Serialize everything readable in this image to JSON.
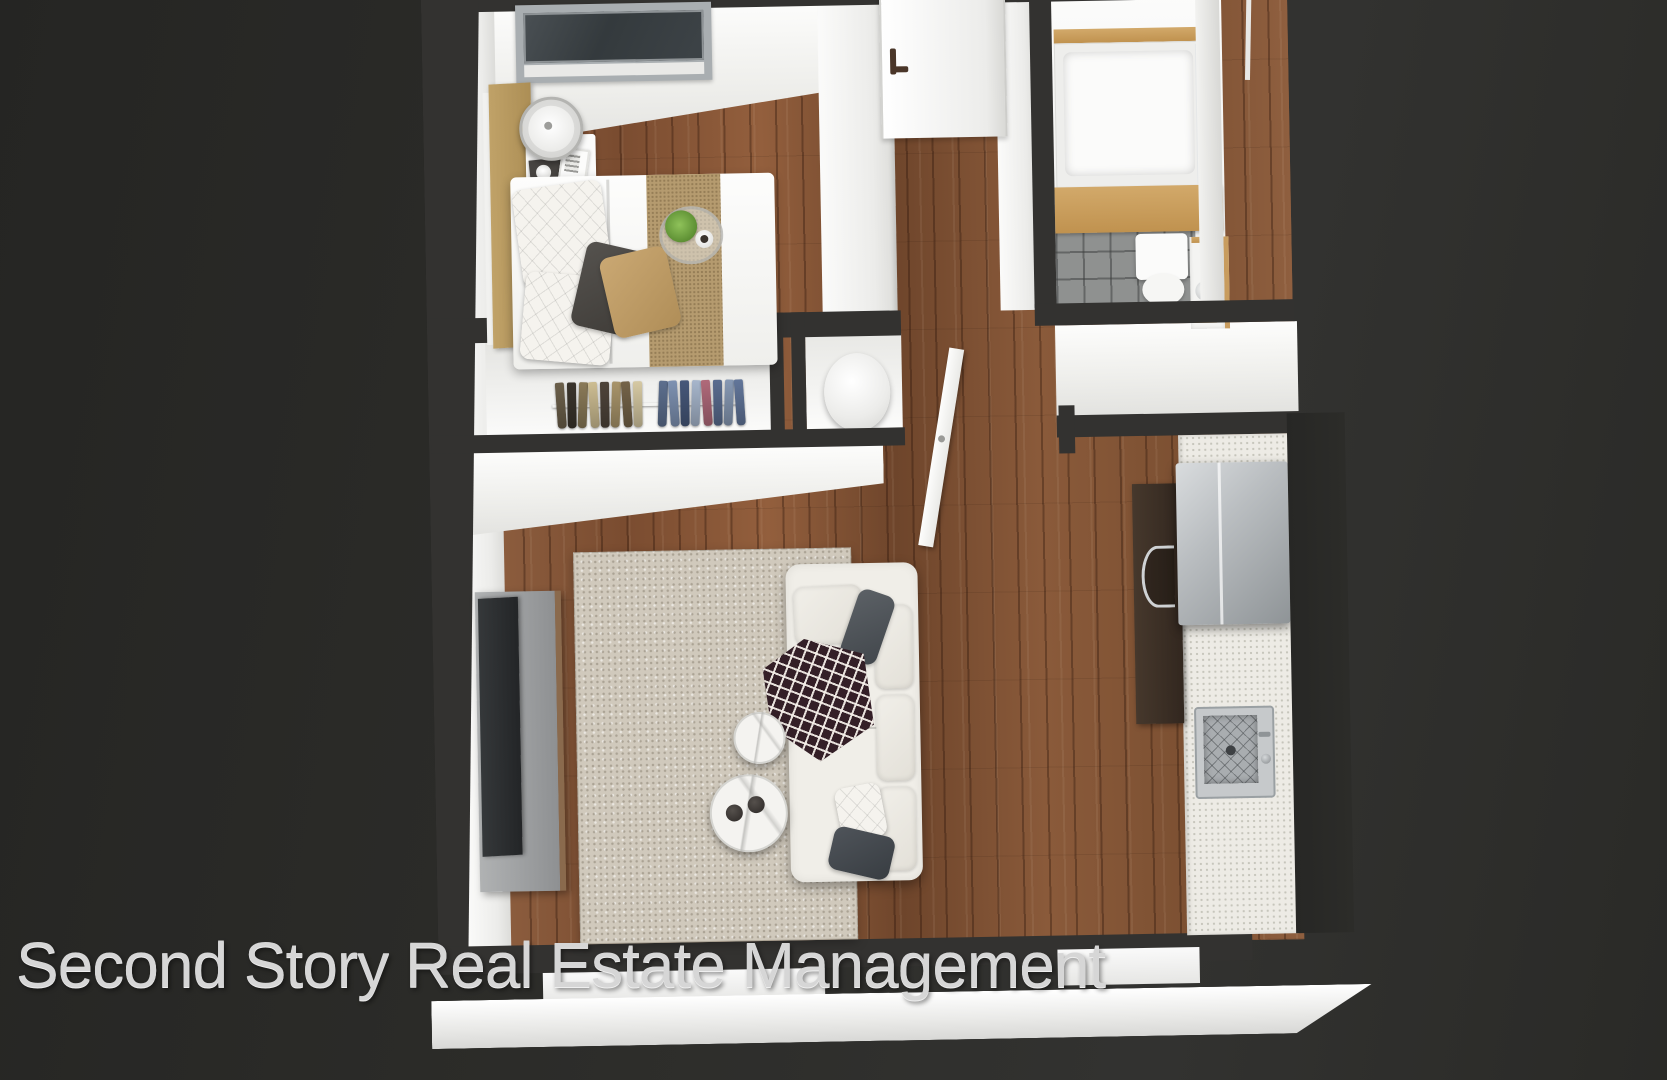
{
  "watermark": {
    "text": "Second Story Real Estate Management"
  },
  "palette": {
    "bg": "#2b2b28",
    "wall-top": "#333230",
    "wall-face": "#f7f7f5",
    "wood": "#85573a",
    "rug": "#d0c9bc",
    "tile": "#8f9190",
    "oak": "#c89c5e",
    "tan": "#b89a64",
    "counter": "#edebe5",
    "cabinet": "#3a2e25",
    "steel": "#a7abae",
    "sofa": "#f0eee8",
    "tv": "#2c2e30",
    "throw": "#341f27",
    "plant": "#6ea13e",
    "pillow-gray": "#53565b",
    "door-handle": "#4a3629"
  },
  "closet": {
    "garments": [
      "#6b5f4a",
      "#3a342c",
      "#8a7a58",
      "#cdbd92",
      "#4e443a",
      "#a8946a",
      "#746348",
      "#d6c9a3",
      "#5d6f8e",
      "#7e92b2",
      "#46587a",
      "#a7b6cc",
      "#b06a7a",
      "#5a6d90",
      "#8799b4",
      "#62769a"
    ]
  }
}
